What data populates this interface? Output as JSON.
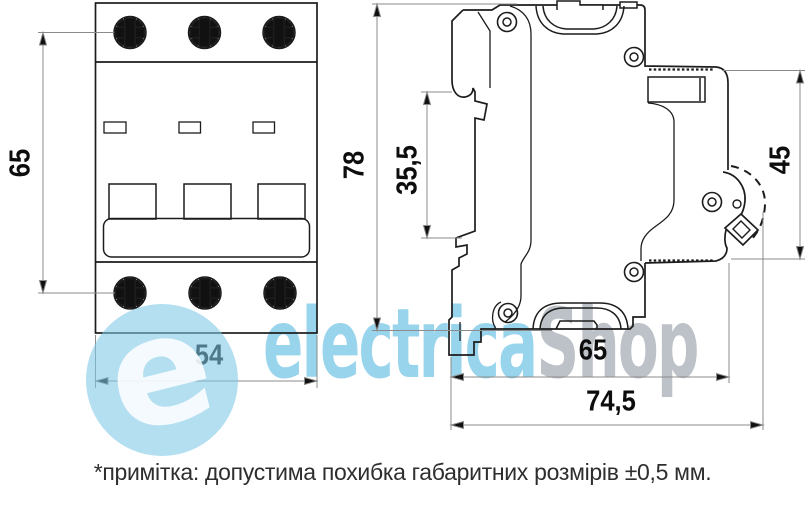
{
  "title": "Circuit breaker dimension drawing",
  "front_view": {
    "width_label": "54",
    "height_label": "65"
  },
  "side_view": {
    "height_label": "78",
    "rail_slot_label": "35,5",
    "front_depth_label": "45",
    "body_depth_label": "65",
    "total_depth_label": "74,5"
  },
  "note": {
    "text": "*примітка: допустима похибка габаритних розмірів ±0,5 мм."
  },
  "watermark": {
    "brand_blue": "electrica",
    "brand_gray": "Shop",
    "logo_letter": "e",
    "accent_blue": "#7cc8e5",
    "accent_gray": "#97a1aa"
  }
}
